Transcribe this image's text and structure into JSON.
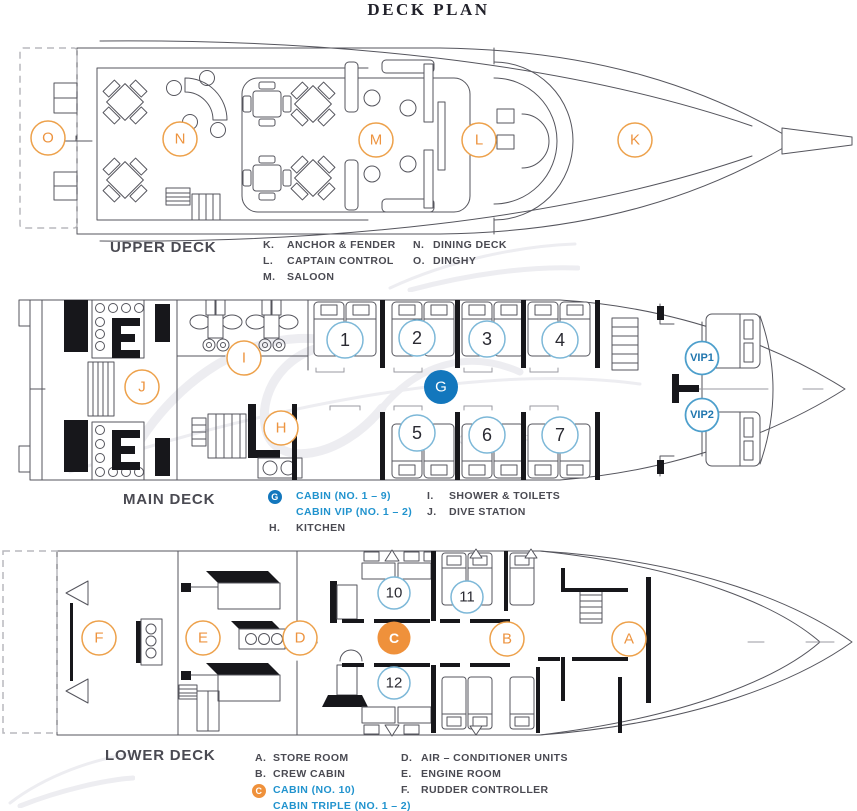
{
  "title": "DECK PLAN",
  "colors": {
    "orange": "#ED9440",
    "blue_fill": "#1377BD",
    "orange_fill": "#EF913B",
    "number_circle_stroke": "#7DB8D8",
    "legend_blue_text": "#2193CE",
    "legend_dark_text": "#4a4a52"
  },
  "watermark_caption": "B O A R D",
  "decks": {
    "upper": {
      "title": "UPPER DECK",
      "markers": {
        "o": "O",
        "n": "N",
        "m": "M",
        "l": "L",
        "k": "K"
      },
      "legend1": [
        {
          "key": "K.",
          "text": "ANCHOR & FENDER"
        },
        {
          "key": "L.",
          "text": "CAPTAIN CONTROL"
        },
        {
          "key": "M.",
          "text": "SALOON"
        }
      ],
      "legend2": [
        {
          "key": "N.",
          "text": "DINING DECK"
        },
        {
          "key": "O.",
          "text": "DINGHY"
        }
      ]
    },
    "main": {
      "title": "MAIN DECK",
      "markers": {
        "j": "J",
        "i": "I",
        "h": "H",
        "g": "G",
        "c1": "1",
        "c2": "2",
        "c3": "3",
        "c4": "4",
        "c5": "5",
        "c6": "6",
        "c7": "7",
        "vip1": "VIP1",
        "vip2": "VIP2"
      },
      "legend1": [
        {
          "badge": "G",
          "text": "CABIN (NO. 1 – 9)"
        },
        {
          "key": "",
          "text": "CABIN VIP (NO. 1 – 2)"
        },
        {
          "key": "H.",
          "text": "KITCHEN"
        }
      ],
      "legend2": [
        {
          "key": "I.",
          "text": "SHOWER & TOILETS"
        },
        {
          "key": "J.",
          "text": "DIVE STATION"
        }
      ]
    },
    "lower": {
      "title": "LOWER DECK",
      "markers": {
        "f": "F",
        "e": "E",
        "d": "D",
        "c": "C",
        "b": "B",
        "a": "A",
        "n10": "10",
        "n11": "11",
        "n12": "12"
      },
      "legend1": [
        {
          "key": "A.",
          "text": "STORE ROOM"
        },
        {
          "key": "B.",
          "text": "CREW CABIN"
        },
        {
          "badge": "C",
          "text": "CABIN (NO. 10)"
        },
        {
          "key": "",
          "text": "CABIN TRIPLE (NO. 1 – 2)"
        }
      ],
      "legend2": [
        {
          "key": "D.",
          "text": "AIR – CONDITIONER UNITS"
        },
        {
          "key": "E.",
          "text": "ENGINE ROOM"
        },
        {
          "key": "F.",
          "text": "RUDDER CONTROLLER"
        }
      ]
    }
  }
}
